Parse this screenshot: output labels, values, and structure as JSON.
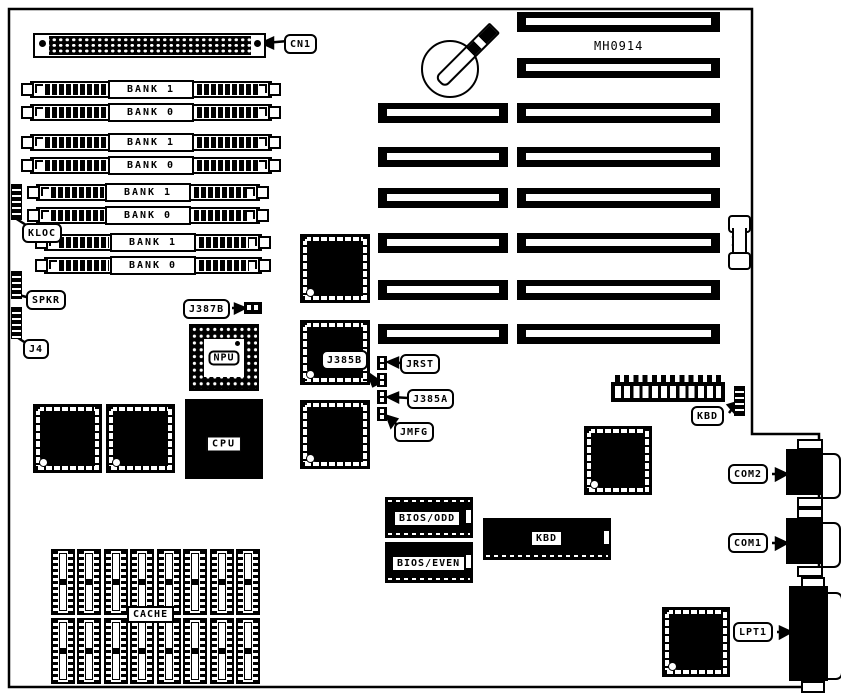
{
  "board": {
    "model_text": "MH0914"
  },
  "callouts": {
    "cn1": "CN1",
    "kloc": "KLOC",
    "spkr": "SPKR",
    "j4": "J4",
    "j387b": "J387B",
    "j385b": "J385B",
    "jrst": "JRST",
    "j385a": "J385A",
    "jmfg": "JMFG",
    "kbd": "KBD",
    "com2": "COM2",
    "com1": "COM1",
    "lpt1": "LPT1"
  },
  "chips": {
    "npu": "NPU",
    "cpu": "CPU",
    "bios_odd": "BIOS/ODD",
    "bios_even": "BIOS/EVEN",
    "kbd": "KBD",
    "cache": "CACHE"
  },
  "memory_banks": [
    "BANK 1",
    "BANK 0",
    "BANK 1",
    "BANK 0",
    "BANK 1",
    "BANK 0",
    "BANK 1",
    "BANK 0"
  ]
}
